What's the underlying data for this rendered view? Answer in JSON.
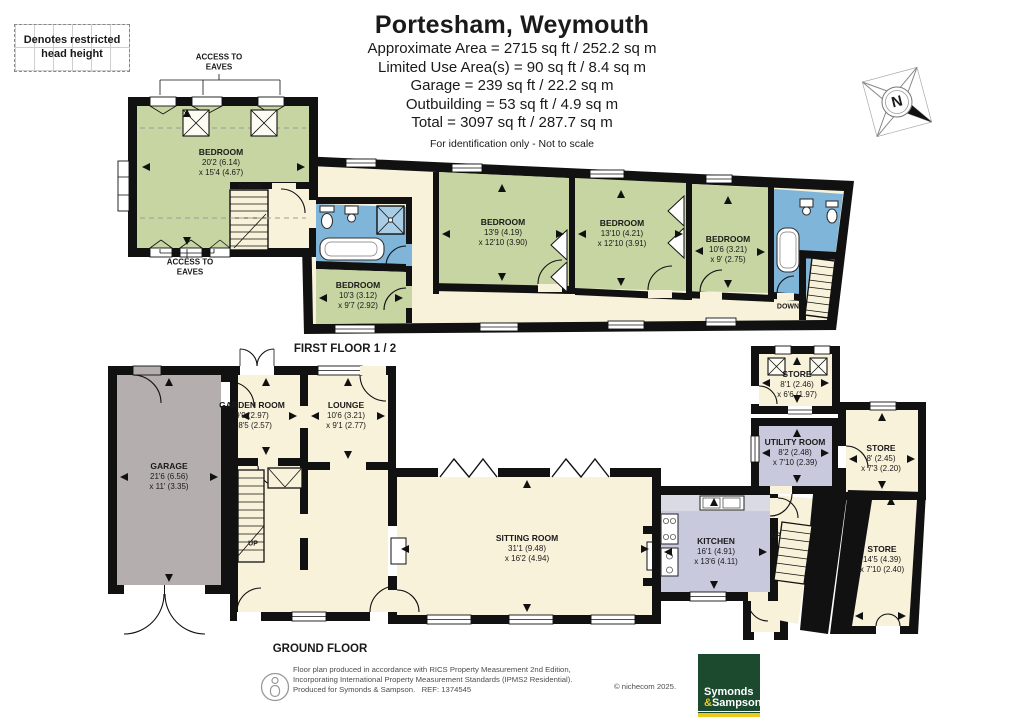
{
  "legend": {
    "text": "Denotes restricted head height"
  },
  "header": {
    "title": "Portesham, Weymouth",
    "lines": [
      "Approximate Area = 2715 sq ft / 252.2 sq m",
      "Limited Use Area(s) = 90 sq ft / 8.4 sq m",
      "Garage = 239 sq ft / 22.2 sq m",
      "Outbuilding = 53 sq ft / 4.9 sq m",
      "Total = 3097 sq ft / 287.7 sq m"
    ],
    "disclaimer": "For identification only - Not to scale"
  },
  "compass": {
    "north": "N"
  },
  "first_floor": {
    "label": "FIRST FLOOR 1 / 2",
    "access_to_eaves": "ACCESS TO EAVES",
    "down": "DOWN",
    "rooms": {
      "bedroom1": {
        "name": "BEDROOM",
        "dim1": "20'2 (6.14)",
        "dim2": "x 15'4 (4.67)"
      },
      "bedroom2": {
        "name": "BEDROOM",
        "dim1": "10'3 (3.12)",
        "dim2": "x 9'7 (2.92)"
      },
      "bedroom3": {
        "name": "BEDROOM",
        "dim1": "13'9 (4.19)",
        "dim2": "x 12'10 (3.90)"
      },
      "bedroom4": {
        "name": "BEDROOM",
        "dim1": "13'10 (4.21)",
        "dim2": "x 12'10 (3.91)"
      },
      "bedroom5": {
        "name": "BEDROOM",
        "dim1": "10'6 (3.21)",
        "dim2": "x 9' (2.75)"
      }
    }
  },
  "ground_floor": {
    "label": "GROUND FLOOR",
    "up": "UP",
    "rooms": {
      "garage": {
        "name": "GARAGE",
        "dim1": "21'6 (6.56)",
        "dim2": "x 11' (3.35)"
      },
      "garden_room": {
        "name": "GARDEN ROOM",
        "dim1": "9'9 (2.97)",
        "dim2": "x 8'5 (2.57)"
      },
      "lounge": {
        "name": "LOUNGE",
        "dim1": "10'6 (3.21)",
        "dim2": "x 9'1 (2.77)"
      },
      "sitting_room": {
        "name": "SITTING ROOM",
        "dim1": "31'1 (9.48)",
        "dim2": "x 16'2 (4.94)"
      },
      "kitchen": {
        "name": "KITCHEN",
        "dim1": "16'1 (4.91)",
        "dim2": "x 13'6 (4.11)"
      },
      "store_outbuilding": {
        "name": "STORE",
        "dim1": "8'1 (2.46)",
        "dim2": "x 6'6 (1.97)"
      },
      "utility_room": {
        "name": "UTILITY ROOM",
        "dim1": "8'2 (2.48)",
        "dim2": "x 7'10 (2.39)"
      },
      "store_mid": {
        "name": "STORE",
        "dim1": "8' (2.45)",
        "dim2": "x 7'3 (2.20)"
      },
      "store_rear": {
        "name": "STORE",
        "dim1": "14'5 (4.39)",
        "dim2": "x 7'10 (2.40)"
      }
    }
  },
  "footer": {
    "line1": "Floor plan produced in accordance with RICS Property Measurement 2nd Edition,",
    "line2": "Incorporating International Property Measurement Standards (IPMS2 Residential).",
    "line3": "Produced for Symonds & Sampson.   REF: 1374545",
    "copyright": "© nichecom 2025.",
    "logo": {
      "word1": "Symonds",
      "amp": "&",
      "word2": "Sampson"
    }
  },
  "colors": {
    "wall": "#111111",
    "bedroom_green": "#c6d5a2",
    "cream": "#f8f2da",
    "bathroom_blue": "#7fb5d8",
    "garage_grey": "#b5aeae",
    "kitchen_lavender": "#c9c9dd",
    "logo_green": "#1b4a2f",
    "logo_yellow": "#edc91c"
  }
}
